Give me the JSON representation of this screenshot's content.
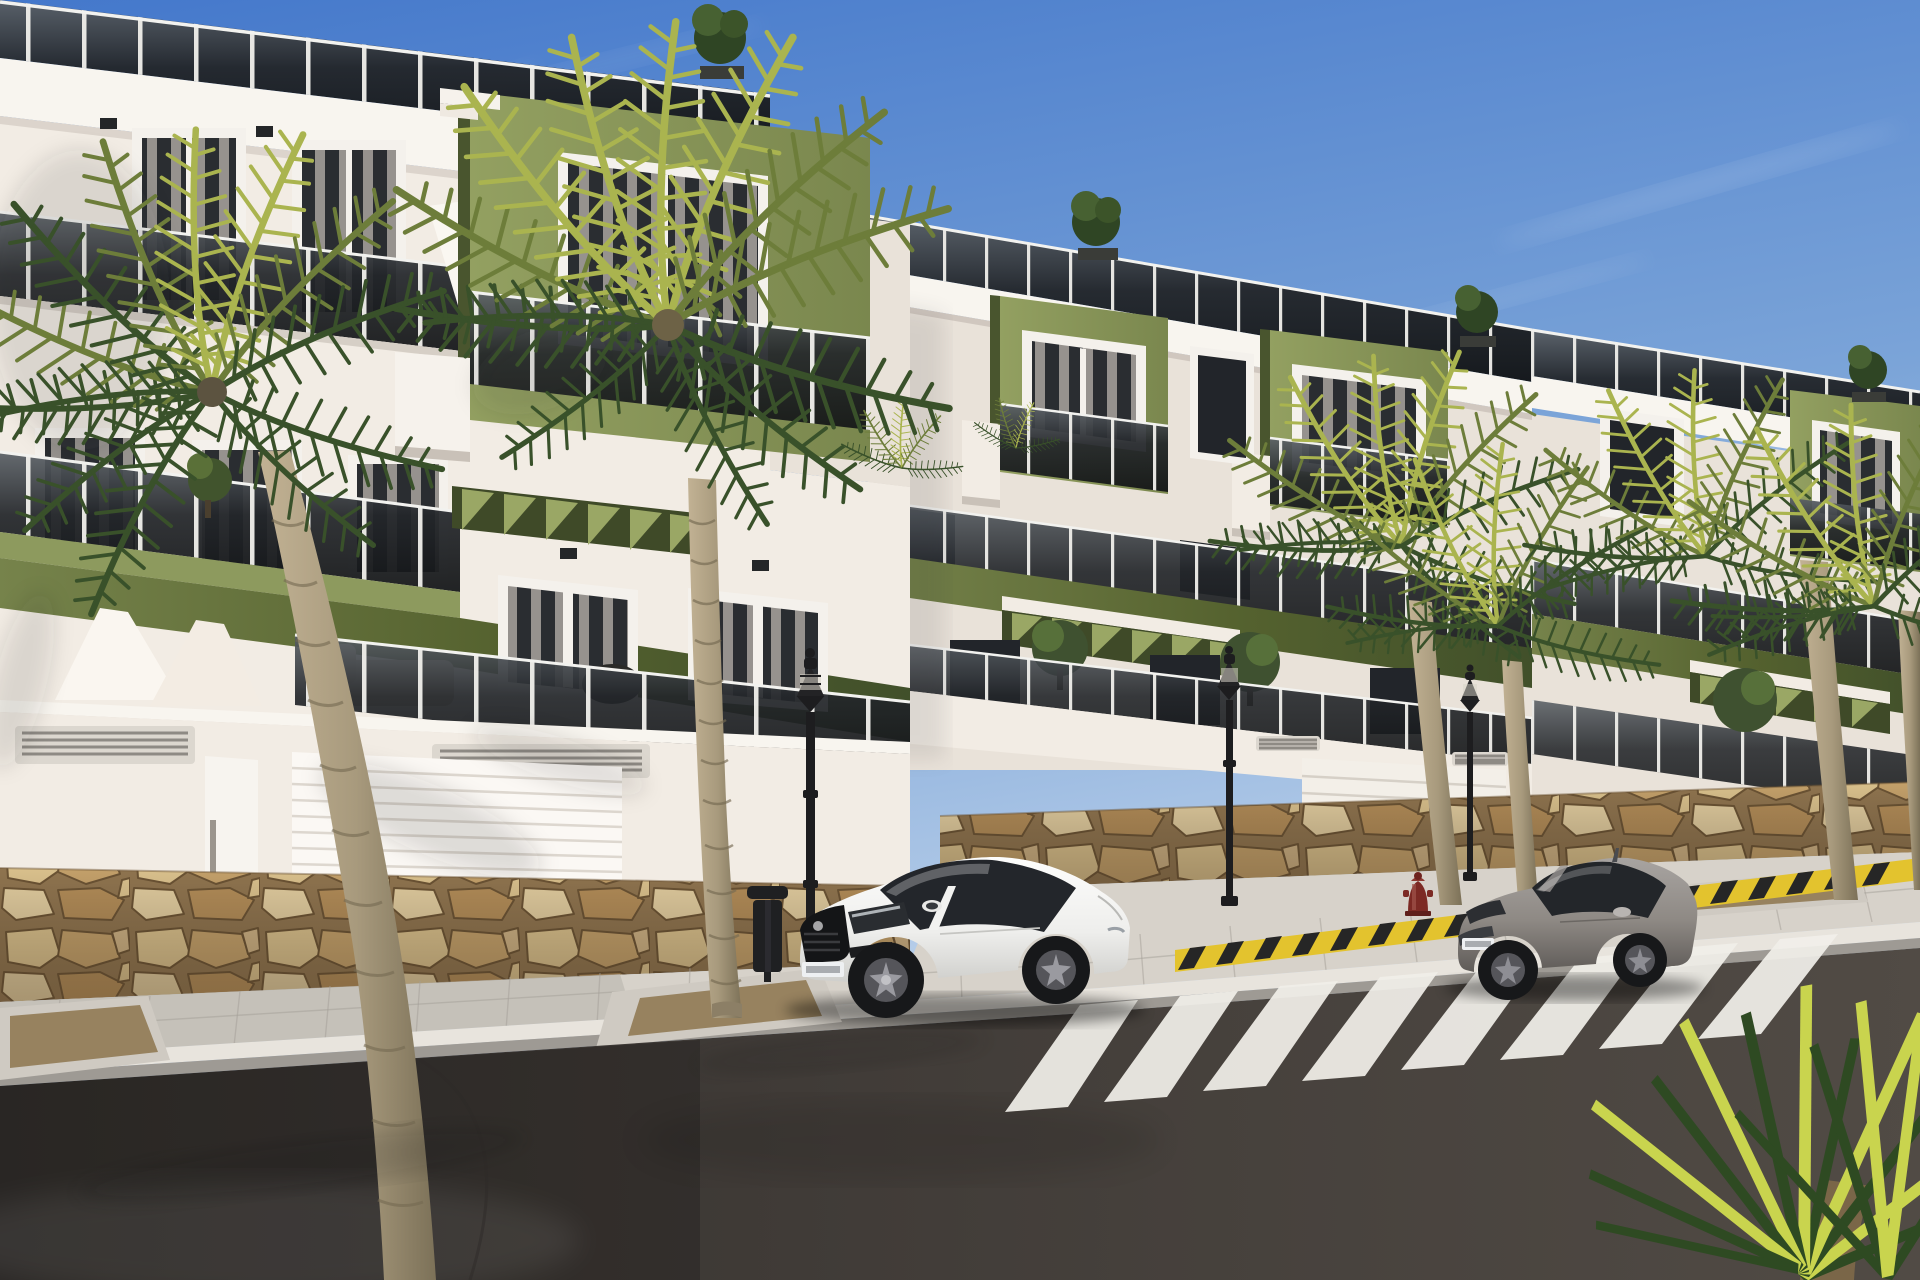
{
  "meta": {
    "title": "Architectural rendering of a modern terraced apartment complex on a sloping street",
    "image_type": "3d-architectural-render",
    "time_of_day": "sunny daytime, clear blue sky"
  },
  "colors": {
    "sky_top": "#4478cb",
    "sky_mid": "#7ba4d8",
    "sky_horizon": "#d7e4f2",
    "cloud": "#ffffff",
    "facade_sun": "#f2ece4",
    "facade_light": "#e9e2d9",
    "facade_shade": "#d9d1c8",
    "facade_deep": "#c9c1b8",
    "cornice": "#f8f5ef",
    "green_sun": "#8d9a5e",
    "green_mid": "#76834b",
    "green_dark": "#49552e",
    "green_deep": "#3f4a28",
    "glass_top": "#5a6066",
    "glass_dark": "#17191c",
    "post": "#f0efeb",
    "rail": "#f2f2ef",
    "window_dark": "#22252a",
    "curtain": "#b9b4ad",
    "frame_white": "#f4f1ec",
    "pergola_light": "#9aa765",
    "stone_bg": "#8f744f",
    "stone_1": "#d9c08c",
    "stone_2": "#c3a06a",
    "stone_3": "#e0cb9e",
    "stone_4": "#b28c58",
    "stone_joint": "#6b5334",
    "sidewalk": "#d7d2ca",
    "sidewalk_shade": "#b7b2ab",
    "curb_top": "#e8e4dd",
    "curb_face": "#9e9a94",
    "paver_joint": "#a49f98",
    "asphalt_dark": "#393531",
    "asphalt_mid": "#45403c",
    "asphalt_light": "#544e48",
    "stripe": "#f1efe9",
    "car_white": "#f6f6f4",
    "car_white_shade": "#d5d5d2",
    "car_glass": "#23262b",
    "tire": "#17181a",
    "rim": "#55555a",
    "car_gray": "#8e8984",
    "car_gray_dark": "#6b6763",
    "lamp_black": "#1d1d1f",
    "bin_black": "#1f2022",
    "hydrant_red": "#7c2a24",
    "barrier_yellow": "#e3c32e",
    "barrier_black": "#262626",
    "trunk_light": "#c2b294",
    "trunk_shade": "#8c7f66",
    "trunk_ring": "#756a52",
    "frond_sun": "#aab44f",
    "frond_mid": "#6d7d3a",
    "frond_dark": "#39512a",
    "blade_bright": "#c9d44e",
    "blade_dark": "#2e4a22",
    "gravel": "#97825f",
    "pit_concrete": "#cfcac2"
  },
  "scene": {
    "buildings": [
      {
        "name": "left-apartment-block",
        "storeys": 3,
        "features": [
          "rooftop glass balustrade",
          "olive-green accent volume",
          "smoked-glass balconies",
          "green pergola",
          "white sectional garage doors",
          "natural stone base"
        ]
      },
      {
        "name": "right-apartment-block",
        "storeys": 3,
        "features": [
          "stepped terraces",
          "two olive-green window volumes",
          "green fascia band",
          "pergola",
          "garage door",
          "stone base"
        ]
      }
    ],
    "vehicles": [
      {
        "name": "white-sports-coupe",
        "parked": true,
        "facing": "left"
      },
      {
        "name": "gray-hatchback-coupe",
        "parked": true,
        "facing": "left"
      }
    ],
    "street": {
      "crosswalk_stripes": 8,
      "street_lamps": 3,
      "trash_bin": 1,
      "fire_hydrant": 1,
      "hazard_striped_curb": 1,
      "tree_pits": 3
    },
    "vegetation": {
      "large_palms": 5,
      "foreground_fan_palm": 1,
      "rooftop_shrubs": 3,
      "balcony_plants": 4
    }
  }
}
